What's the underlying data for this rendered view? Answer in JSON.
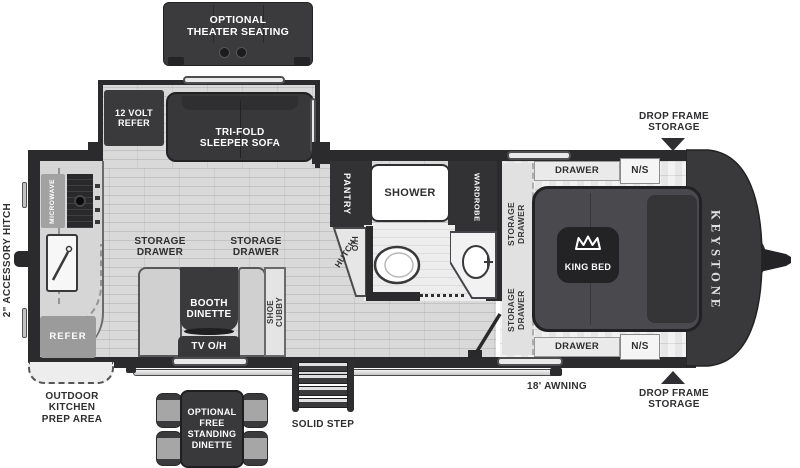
{
  "plan": {
    "brand": "KEYSTONE",
    "accent_dark": "#2e2e31",
    "furniture_dark": "#3a3a3d",
    "floor_gray": "#d9d9d9",
    "appliance_gray": "#9e9e9e",
    "exterior": {
      "theater_seating": "OPTIONAL\nTHEATER SEATING",
      "drop_frame_storage_top": "DROP FRAME\nSTORAGE",
      "drop_frame_storage_bottom": "DROP FRAME\nSTORAGE",
      "accessory_hitch": "2\" ACCESSORY HITCH",
      "awning": "18'  AWNING",
      "solid_step": "SOLID STEP",
      "outdoor_kitchen": "OUTDOOR\nKITCHEN\nPREP AREA",
      "free_standing_dinette": "OPTIONAL\nFREE\nSTANDING\nDINETTE"
    },
    "slide_out": {
      "twelve_volt_refer": "12 VOLT\nREFER",
      "sleeper_sofa": "TRI-FOLD\nSLEEPER SOFA"
    },
    "kitchen": {
      "microwave": "MICROWAVE",
      "refer": "REFER",
      "storage_drawer_left": "STORAGE\nDRAWER",
      "storage_drawer_right": "STORAGE\nDRAWER"
    },
    "living": {
      "booth_dinette": "BOOTH\nDINETTE",
      "tv_overhead": "TV O/H",
      "shoe_cubby": "SHOE\nCUBBY",
      "hutch": "HUTCH",
      "overhead_cabinet": "O/H"
    },
    "bath": {
      "pantry": "PANTRY",
      "shower": "SHOWER",
      "wardrobe": "WARDROBE"
    },
    "bedroom": {
      "drawer_top": "DRAWER",
      "nightstand_top": "N/S",
      "drawer_bottom": "DRAWER",
      "nightstand_bottom": "N/S",
      "storage_drawer_upper": "STORAGE\nDRAWER",
      "storage_drawer_lower": "STORAGE\nDRAWER",
      "king_bed": "KING BED"
    }
  }
}
